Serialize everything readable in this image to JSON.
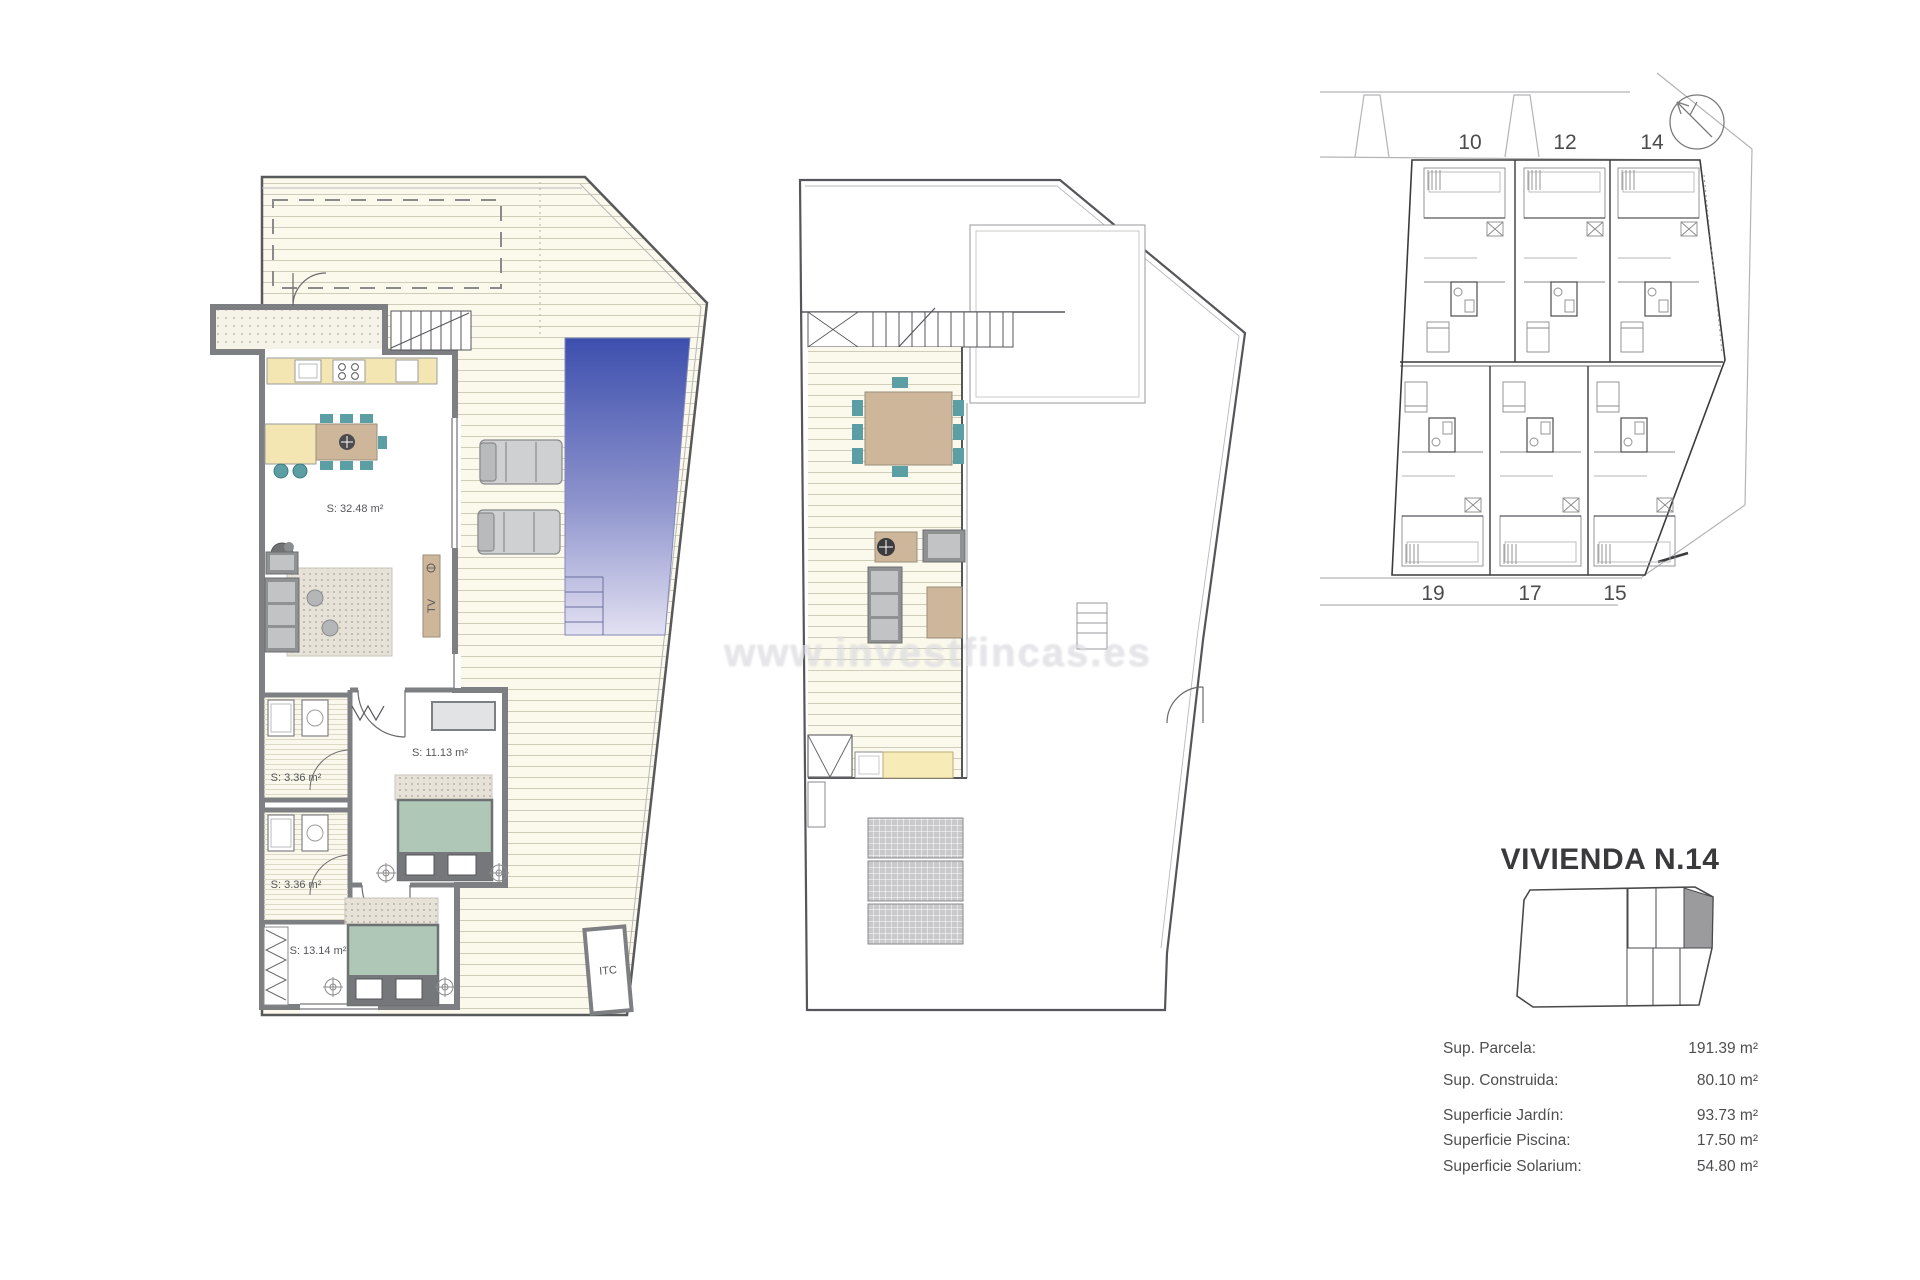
{
  "watermark": {
    "text": "www.investfincas.es"
  },
  "ground_floor_plan": {
    "rooms": {
      "living_kitchen": "S: 32.48 m²",
      "bathroom_1": "S: 3.36 m²",
      "bathroom_2": "S: 3.36 m²",
      "bedroom_1": "S: 11.13 m²",
      "bedroom_2": "S: 13.14 m²",
      "itc_closet": "ITC",
      "tv_unit": "TV"
    }
  },
  "site_plan": {
    "top_units": [
      "10",
      "12",
      "14"
    ],
    "bottom_units": [
      "19",
      "17",
      "15"
    ]
  },
  "info_panel": {
    "title": "VIVIENDA N.14",
    "specs": [
      {
        "label": "Sup. Parcela:",
        "value": "191.39 m²"
      },
      {
        "label": "Sup. Construida:",
        "value": "80.10 m²"
      },
      {
        "label": "Superficie Jardín:",
        "value": "93.73 m²"
      },
      {
        "label": "Superficie Piscina:",
        "value": "17.50 m²"
      },
      {
        "label": "Superficie Solarium:",
        "value": "54.80 m²"
      }
    ]
  },
  "colors": {
    "pool_top": "#3D4FAE",
    "pool_bottom": "#E2E0F2",
    "deck_cream": "#FBF9EC",
    "counter_yellow": "#F4E6B2",
    "furniture_tan": "#CDB69A",
    "chair_teal": "#5B9EA3",
    "bed_sage": "#AFC7B6",
    "wall_gray": "#7D7F82",
    "highlight_unit_gray": "#9B9B9D"
  }
}
